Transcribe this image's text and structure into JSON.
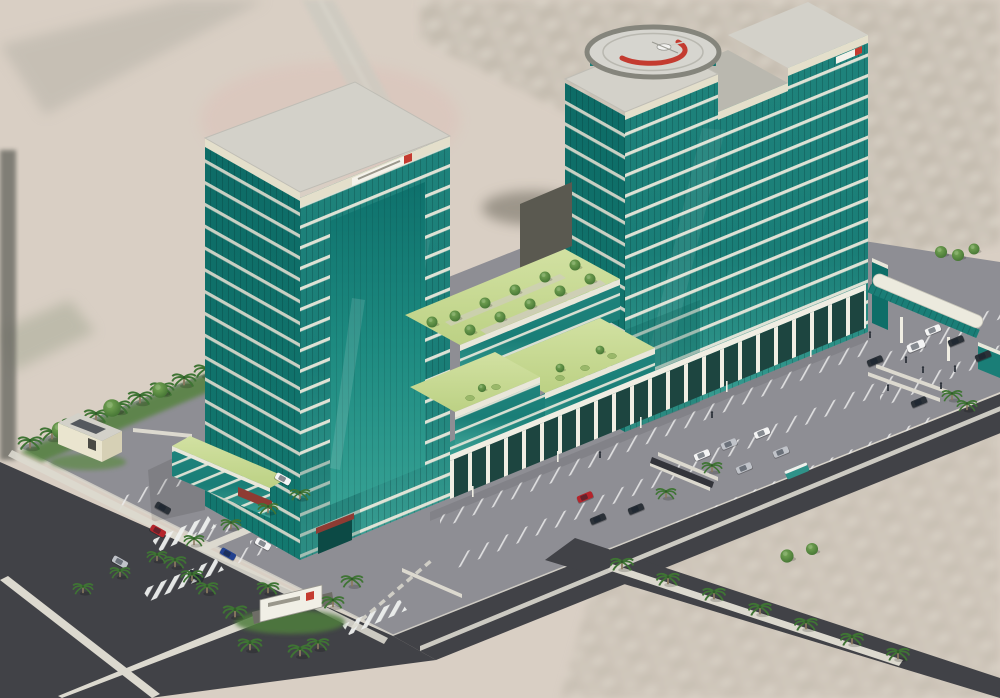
{
  "scene": {
    "title": "Aerial 3D architectural rendering: twin teal-glass high-rise towers with a rooftop helipad, terraced sky gardens, column arcade podium, landscaped surface parking, palm-lined roads and a glazed pedestrian bridge",
    "labels": {
      "background": "Blurred aerial satellite terrain and city blocks",
      "parking": "Surface parking lot with striped stalls",
      "roads": "Perimeter asphalt roads with medians and crosswalks",
      "leftTower": "Left teal glass office tower with banded curtain wall",
      "rightTower": "Right teal glass office tower (taller, stepped parapet)",
      "helipad": "Circular rooftop helipad with red crescent logo and parked helicopter",
      "helicopter": "Small white helicopter",
      "gardens": "Terraced rooftop gardens with lawns, paths and round trees",
      "arcade": "Ground-floor colonnade arcade of white columns",
      "bridge": "Glazed pedestrian bridge with white barrel roof",
      "monumentSign": "Entrance monument sign with red logo",
      "towerSignLeft": "Parapet nameplate with red logo (illegible)",
      "towerSignRight": "Parapet nameplate with red logo (illegible)",
      "utility": "Small cream utility building",
      "vegetation": "Palm trees, hedges and round trees",
      "vehicles": "Assorted parked cars, van and teal shuttle bus",
      "people": "Pedestrians near the bridge and arcade",
      "canopy": "Dark red entrance canopy"
    }
  },
  "palette": {
    "terrain": "#d9cfc4",
    "terrainShade": "#c6bdb1",
    "pinkPatch": "#ddc0b8",
    "cityA": "#cdc6ba",
    "cityB": "#b6b0a4",
    "road": "#414247",
    "roadDark": "#33343a",
    "median": "#dcd9cf",
    "lot": "#8e8e94",
    "kerb": "#d8d5cb",
    "glassDark": "#0e6e68",
    "glassMid": "#1a7e77",
    "glassLight": "#2f938a",
    "bandWhite": "#e9e7da",
    "parapet": "#e4dfcb",
    "roof": "#d3d1c9",
    "roofShade": "#bab8af",
    "lawn": "#c8d894",
    "tree": "#4a7a36",
    "palm": "#3f7434",
    "trunk": "#8a7a5f",
    "shadowTeal": "#1d4540",
    "column": "#f0eee3",
    "cream": "#eae5cf",
    "creamShade": "#d6d0b5",
    "darkWall": "#5a5950",
    "canopyRed": "#8e3b33",
    "logoRed": "#c43b30",
    "heliPad": "#d6d5cf",
    "heliRing": "#85857c",
    "carWhite": "#f4f4f4",
    "carSilver": "#c0c3c9",
    "carDark": "#2b3138",
    "carRed": "#b5242b",
    "carBlue": "#22418f",
    "busTeal": "#2f9289",
    "people": "#2e333b"
  }
}
